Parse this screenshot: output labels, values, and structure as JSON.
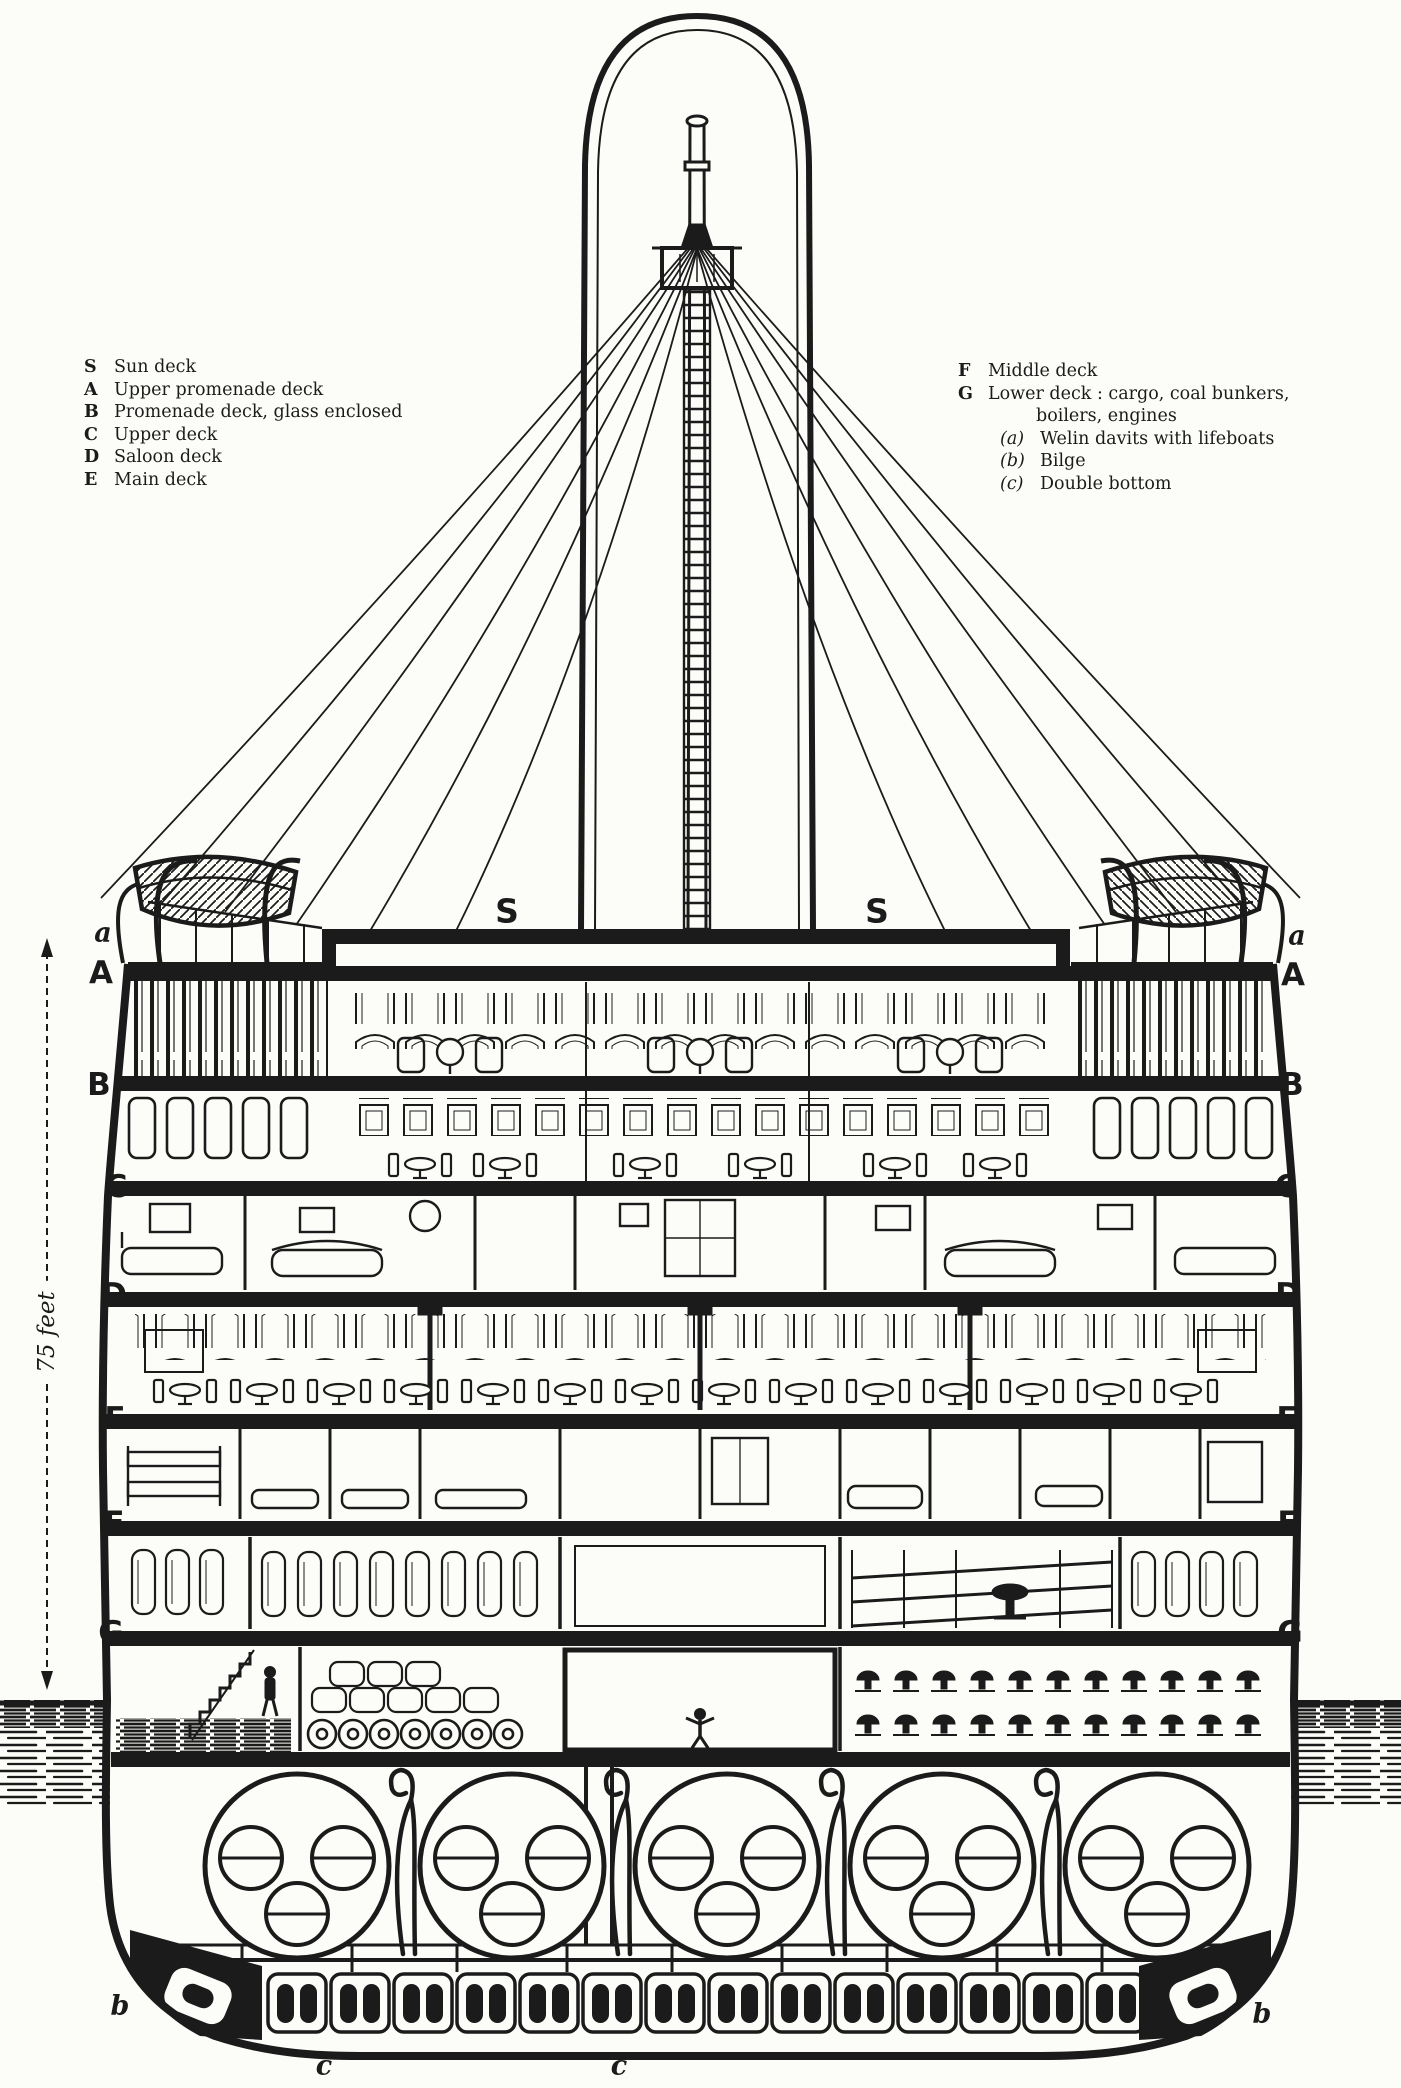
{
  "figure": {
    "description": "Cross-section engraving of an ocean liner amidships"
  },
  "legend_left": {
    "items": [
      {
        "key": "S",
        "label": "Sun deck"
      },
      {
        "key": "A",
        "label": "Upper promenade deck"
      },
      {
        "key": "B",
        "label": "Promenade deck, glass enclosed"
      },
      {
        "key": "C",
        "label": "Upper deck"
      },
      {
        "key": "D",
        "label": "Saloon deck"
      },
      {
        "key": "E",
        "label": "Main deck"
      }
    ]
  },
  "legend_right": {
    "items": [
      {
        "key": "F",
        "label": "Middle deck"
      },
      {
        "key": "G",
        "label": "Lower deck : cargo, coal bunkers,",
        "label_cont": "boilers, engines"
      }
    ],
    "sub_items": [
      {
        "key": "(a)",
        "label": "Welin davits with lifeboats"
      },
      {
        "key": "(b)",
        "label": "Bilge"
      },
      {
        "key": "(c)",
        "label": "Double bottom"
      }
    ]
  },
  "deck_marks": {
    "sun_left": "S",
    "sun_right": "S",
    "left": [
      "a",
      "A",
      "B",
      "C",
      "D",
      "E",
      "F",
      "G"
    ],
    "right": [
      "a",
      "A",
      "B",
      "C",
      "D",
      "E",
      "F",
      "G"
    ],
    "bilge_left": "b",
    "bilge_right": "b",
    "double_bottom_left": "c",
    "double_bottom_right": "c"
  },
  "measure": {
    "label": "75 feet"
  },
  "colors": {
    "ink": "#1b1b1b",
    "paper": "#fcfcf8"
  }
}
